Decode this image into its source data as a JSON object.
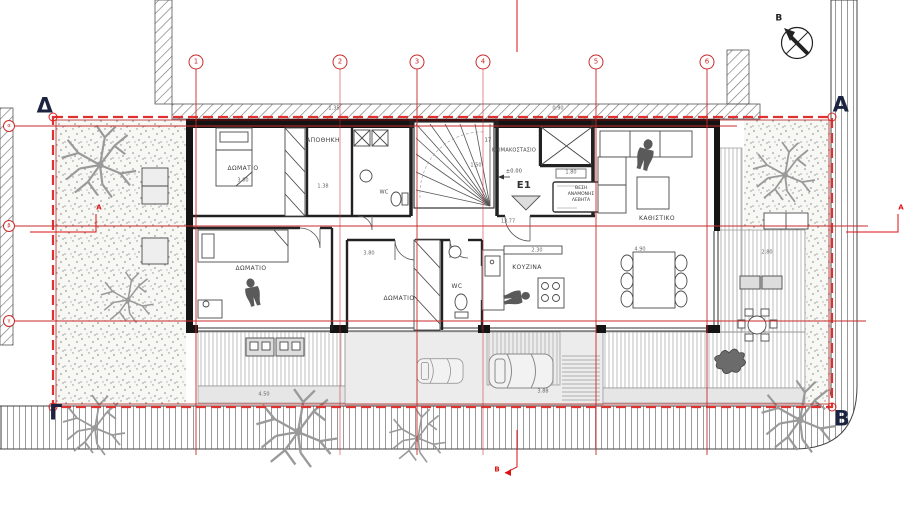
{
  "corners": {
    "top_left": "Δ",
    "top_right": "Α",
    "bottom_left": "Γ",
    "bottom_right": "Β"
  },
  "north": {
    "label": "Β"
  },
  "grid": {
    "columns": [
      "1",
      "2",
      "3",
      "4",
      "5",
      "6"
    ],
    "rows": [
      "α",
      "β",
      "γ"
    ]
  },
  "sections": {
    "a": "Α",
    "b": "Β"
  },
  "entrance": {
    "id": "E1",
    "level": "±0.00"
  },
  "rooms": {
    "bedroom1": "ΔΩΜΑΤΙΟ",
    "bedroom2": "ΔΩΜΑΤΙΟ",
    "bedroom3": "ΔΩΜΑΤΙΟ",
    "storage": "ΑΠΟΘΗΚΗ",
    "staircase": "ΚΛΙΜΑΚΟΣΤΑΣΙΟ",
    "living": "ΚΑΘΙΣΤΙΚΟ",
    "kitchen": "ΚΟΥΖΙΝΑ",
    "wc": "WC",
    "wc_top": "WC",
    "stairs_count": "17",
    "boiler_line1": "ΘΕΣΗ",
    "boiler_line2": "ΑΝΑΜΟΝΗΣ",
    "boiler_line3": "ΛΕΒΗΤΑ"
  },
  "dims": {
    "bedroom1": "3.60",
    "storage": "1.38",
    "stair": "1.50",
    "elevator": "1.80",
    "entry": "13.77",
    "kitchen": "2.30",
    "dining": "4.90",
    "bedroom3": "3.80",
    "deck_right": "2.80",
    "driveway": "3.88",
    "deck_left": "4.50",
    "top_a": "1.35",
    "top_b": "0.90"
  },
  "colors": {
    "grid_red": "#c92a2a",
    "boundary_red": "#e03131",
    "wall_black": "#181818",
    "hatch_gray": "#8c8c8c"
  }
}
